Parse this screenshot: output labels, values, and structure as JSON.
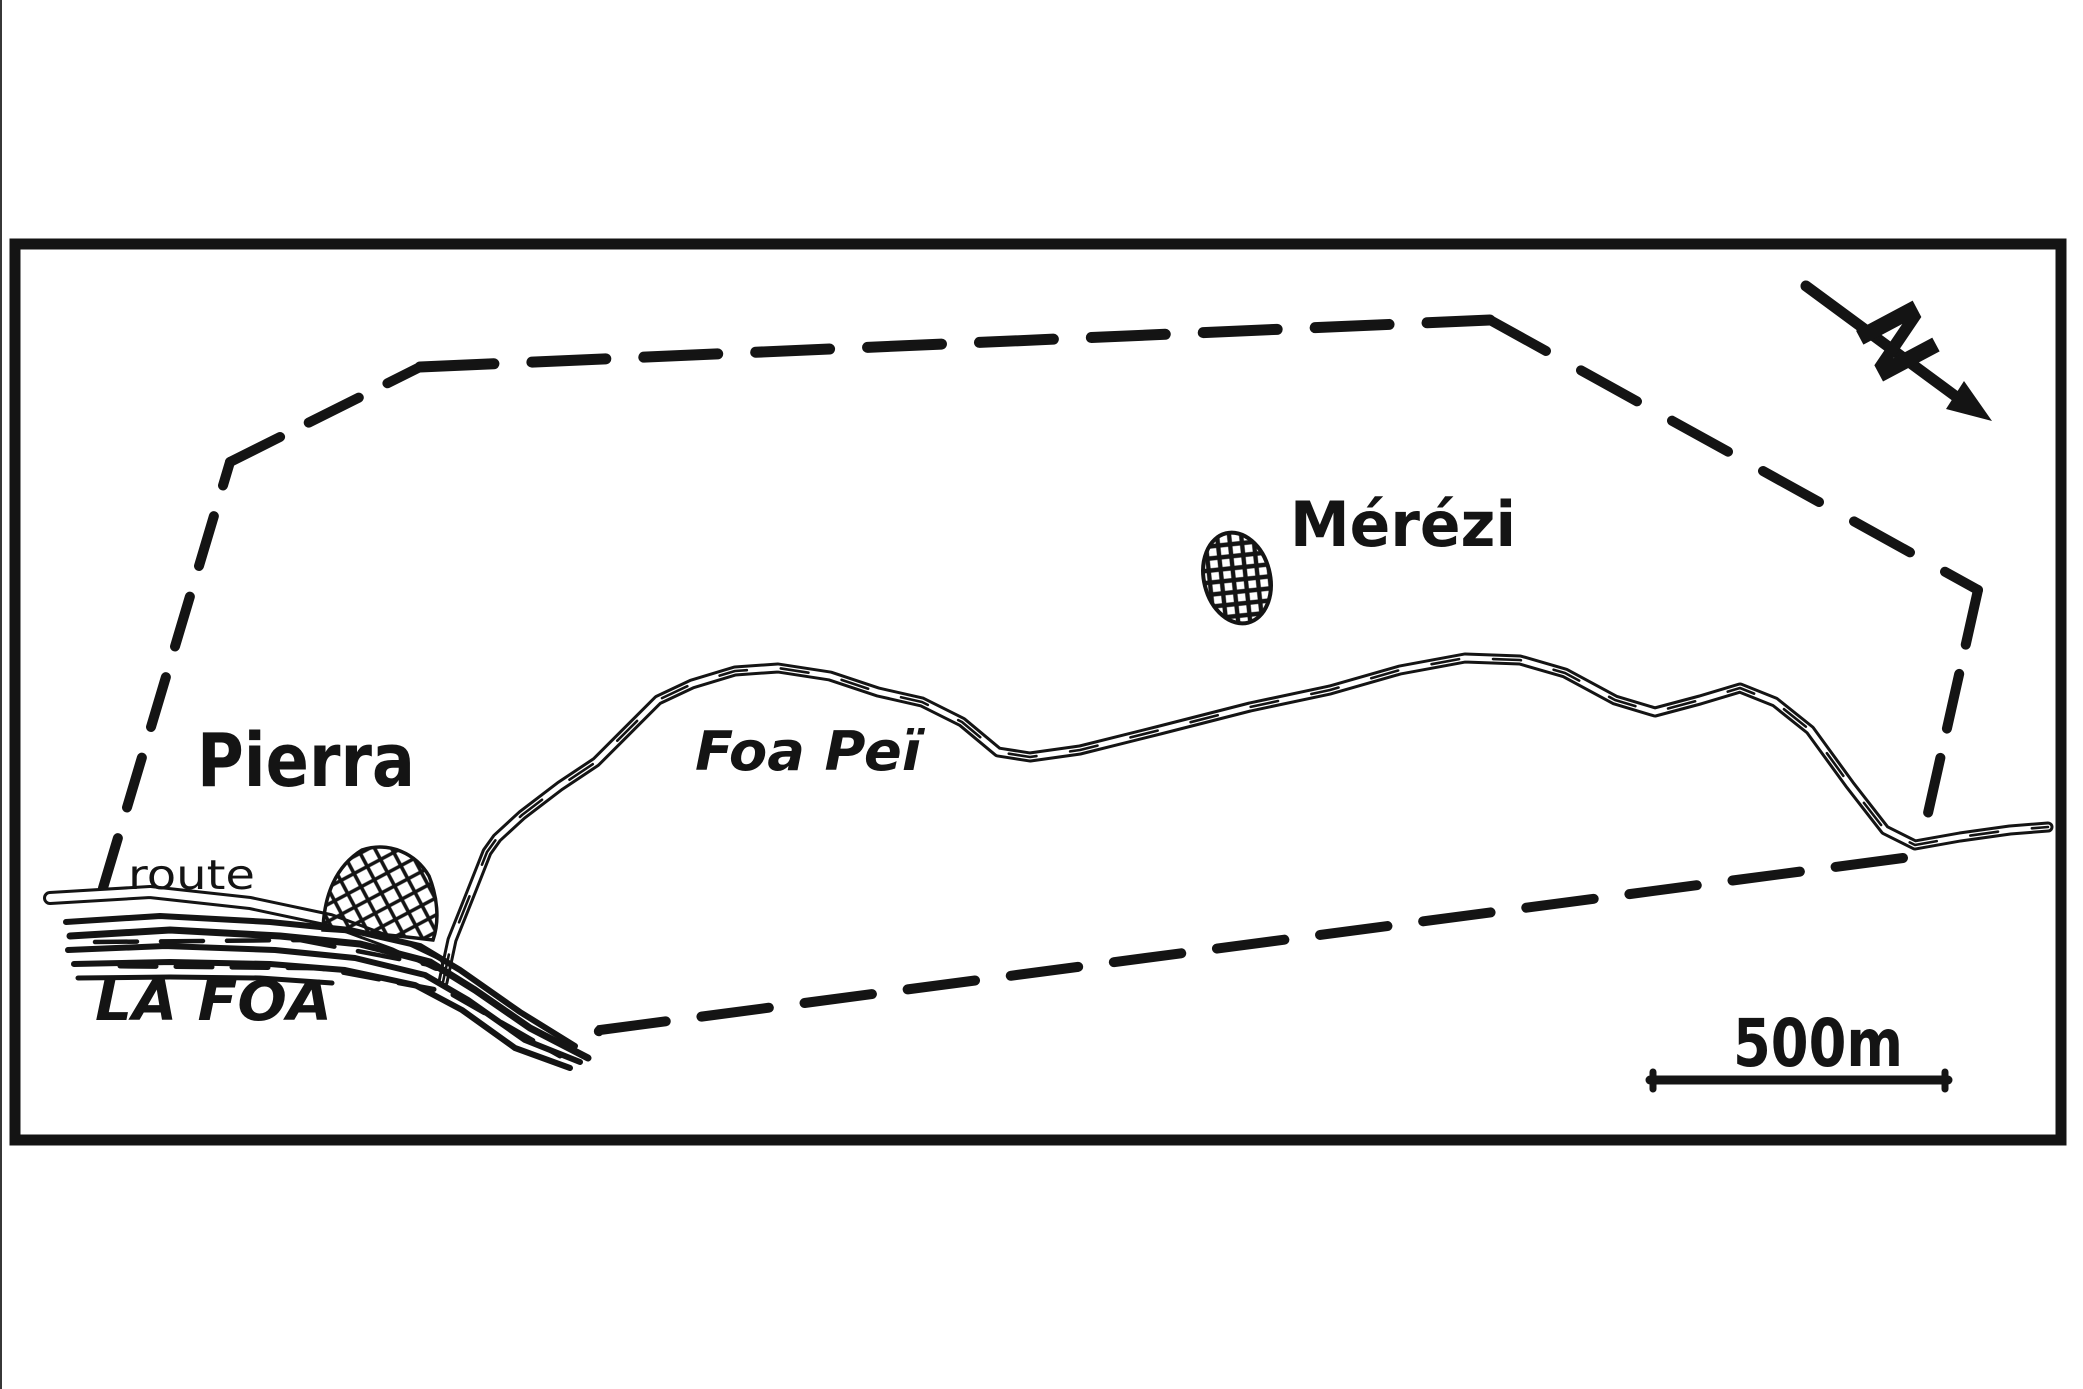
{
  "map": {
    "labels": {
      "village_pierra": "Pierra",
      "village_merezi": "Mérézi",
      "stream_foa_pei": "Foa Peï",
      "river_la_foa": "LA FOA",
      "road_route": "route",
      "north_letter": "N"
    },
    "scale_bar": {
      "label": "500m"
    },
    "colors": {
      "ink": "#141414",
      "paper": "#ffffff"
    }
  }
}
